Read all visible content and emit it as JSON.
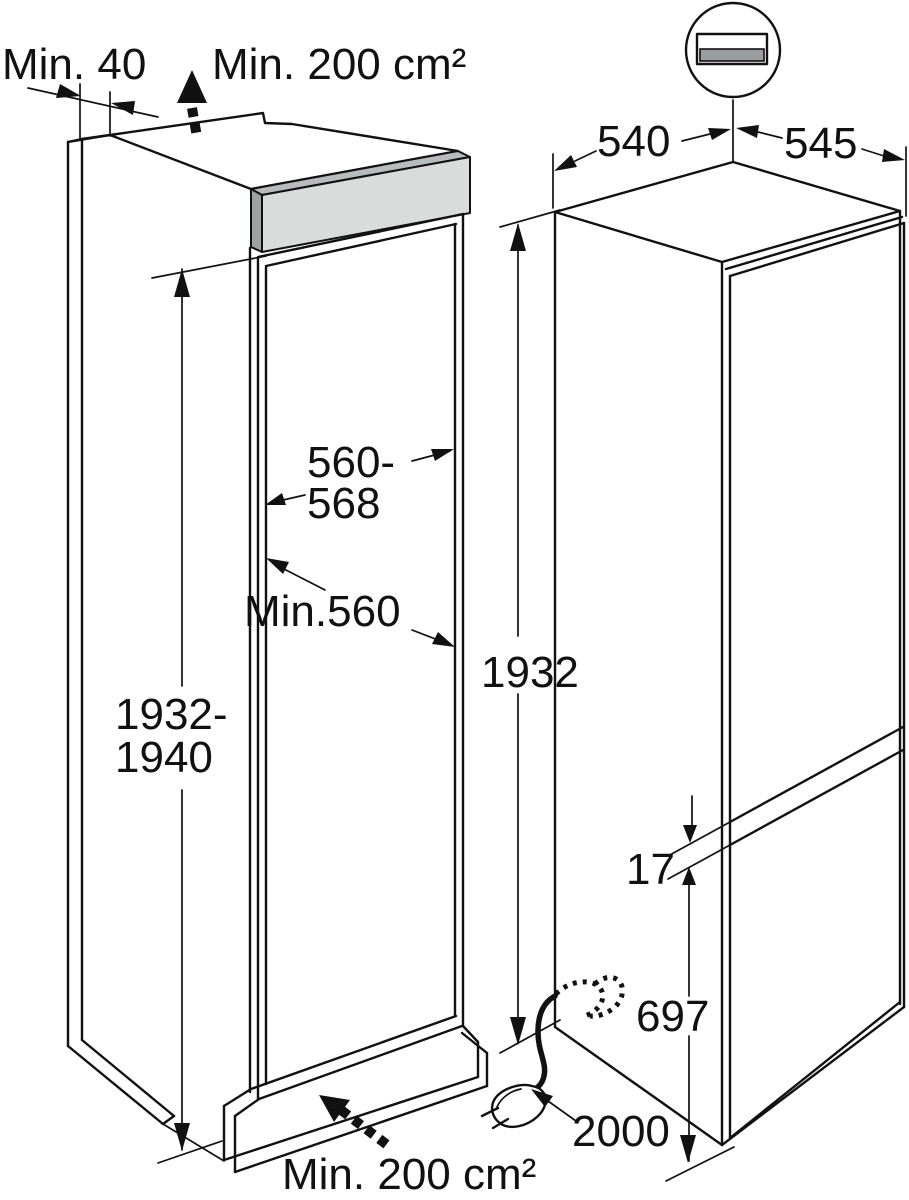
{
  "title": "Built-in fridge-freezer installation dimensions diagram",
  "colors": {
    "line": "#111111",
    "bar_face": "#dadcdc",
    "bar_bevel": "#b9bcbc",
    "bar_cap": "#9fa2a2",
    "grille_gray": "#9b9e9e"
  },
  "niche": {
    "rear_gap_label": "Min. 40",
    "vent_top_label": "Min. 200 cm²",
    "width_range_line1": "560-",
    "width_range_line2": "568",
    "min_width_label": "Min.560",
    "height_range_line1": "1932-",
    "height_range_line2": "1940",
    "vent_bottom_label": "Min. 200 cm²"
  },
  "appliance": {
    "depth_label": "540",
    "width_label": "545",
    "height_label": "1932",
    "door_gap_label": "17",
    "lower_section_label": "697",
    "cable_length_label": "2000"
  }
}
